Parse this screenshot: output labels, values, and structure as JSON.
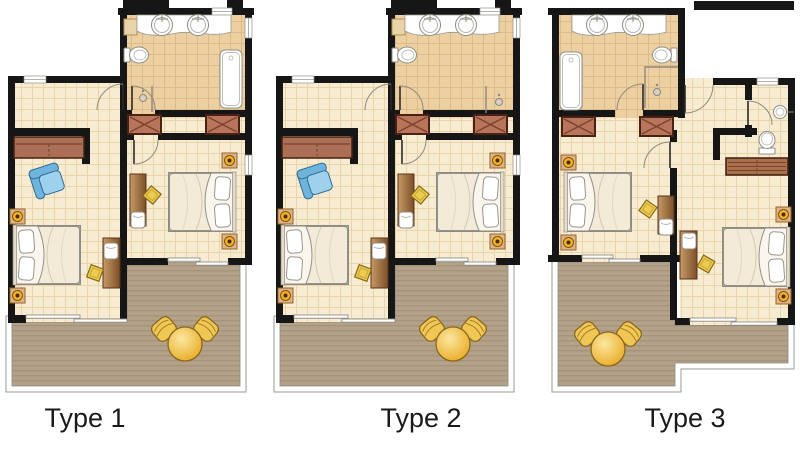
{
  "plans": [
    {
      "label": "Type 1"
    },
    {
      "label": "Type 2"
    },
    {
      "label": "Type 3"
    }
  ],
  "colors": {
    "wall": "#161616",
    "tile_floor": "#f7ecd2",
    "tile_line": "#e9d5aa",
    "bath_floor": "#ecd0a2",
    "bath_line": "#dcba8a",
    "deck": "#b3a289",
    "deck_line": "#9f8e74",
    "closet": "#b8755c",
    "sofa": "#aa6f55",
    "armchair": "#8cc6e6",
    "table_gold": "#eebf45",
    "stool": "#ecc94e",
    "lamp": "#f2b22c",
    "label": "#1a1a1a"
  }
}
